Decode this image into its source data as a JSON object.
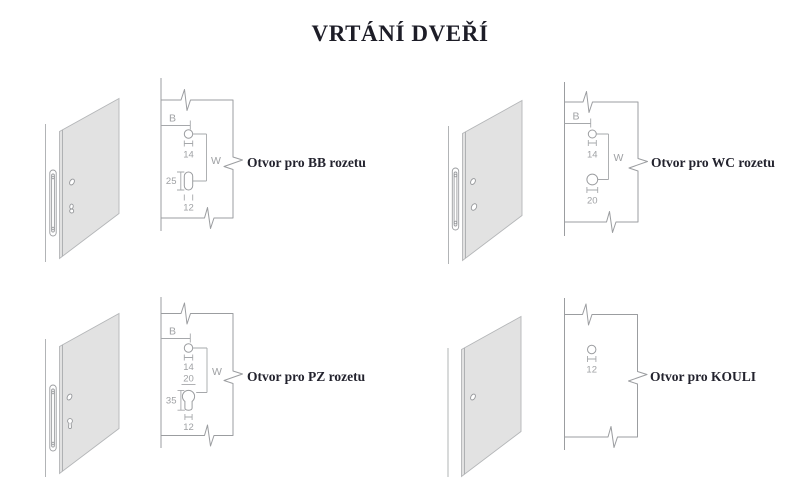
{
  "title": "VRTÁNÍ DVEŘÍ",
  "colors": {
    "heading_text": "#1d1d27",
    "label_text": "#23232e",
    "drawing_line": "#9b9da0",
    "dimension_text": "#9fa1a4",
    "door_panel_fill": "#e2e2e2"
  },
  "sections": {
    "bb": {
      "label": "Otvor pro BB rozetu",
      "dim_b": "B",
      "dim_w": "W",
      "top_hole_dia": "14",
      "slot_height": "25",
      "slot_width": "12"
    },
    "wc": {
      "label": "Otvor pro WC rozetu",
      "dim_b": "B",
      "dim_w": "W",
      "top_hole_dia": "14",
      "bottom_hole_dia": "20"
    },
    "pz": {
      "label": "Otvor pro PZ rozetu",
      "dim_b": "B",
      "dim_w": "W",
      "top_hole_dia": "14",
      "cylinder_dia": "20",
      "cylinder_height": "35",
      "cylinder_tail_width": "12"
    },
    "kouli": {
      "label": "Otvor pro KOULI",
      "hole_dia": "12"
    }
  }
}
